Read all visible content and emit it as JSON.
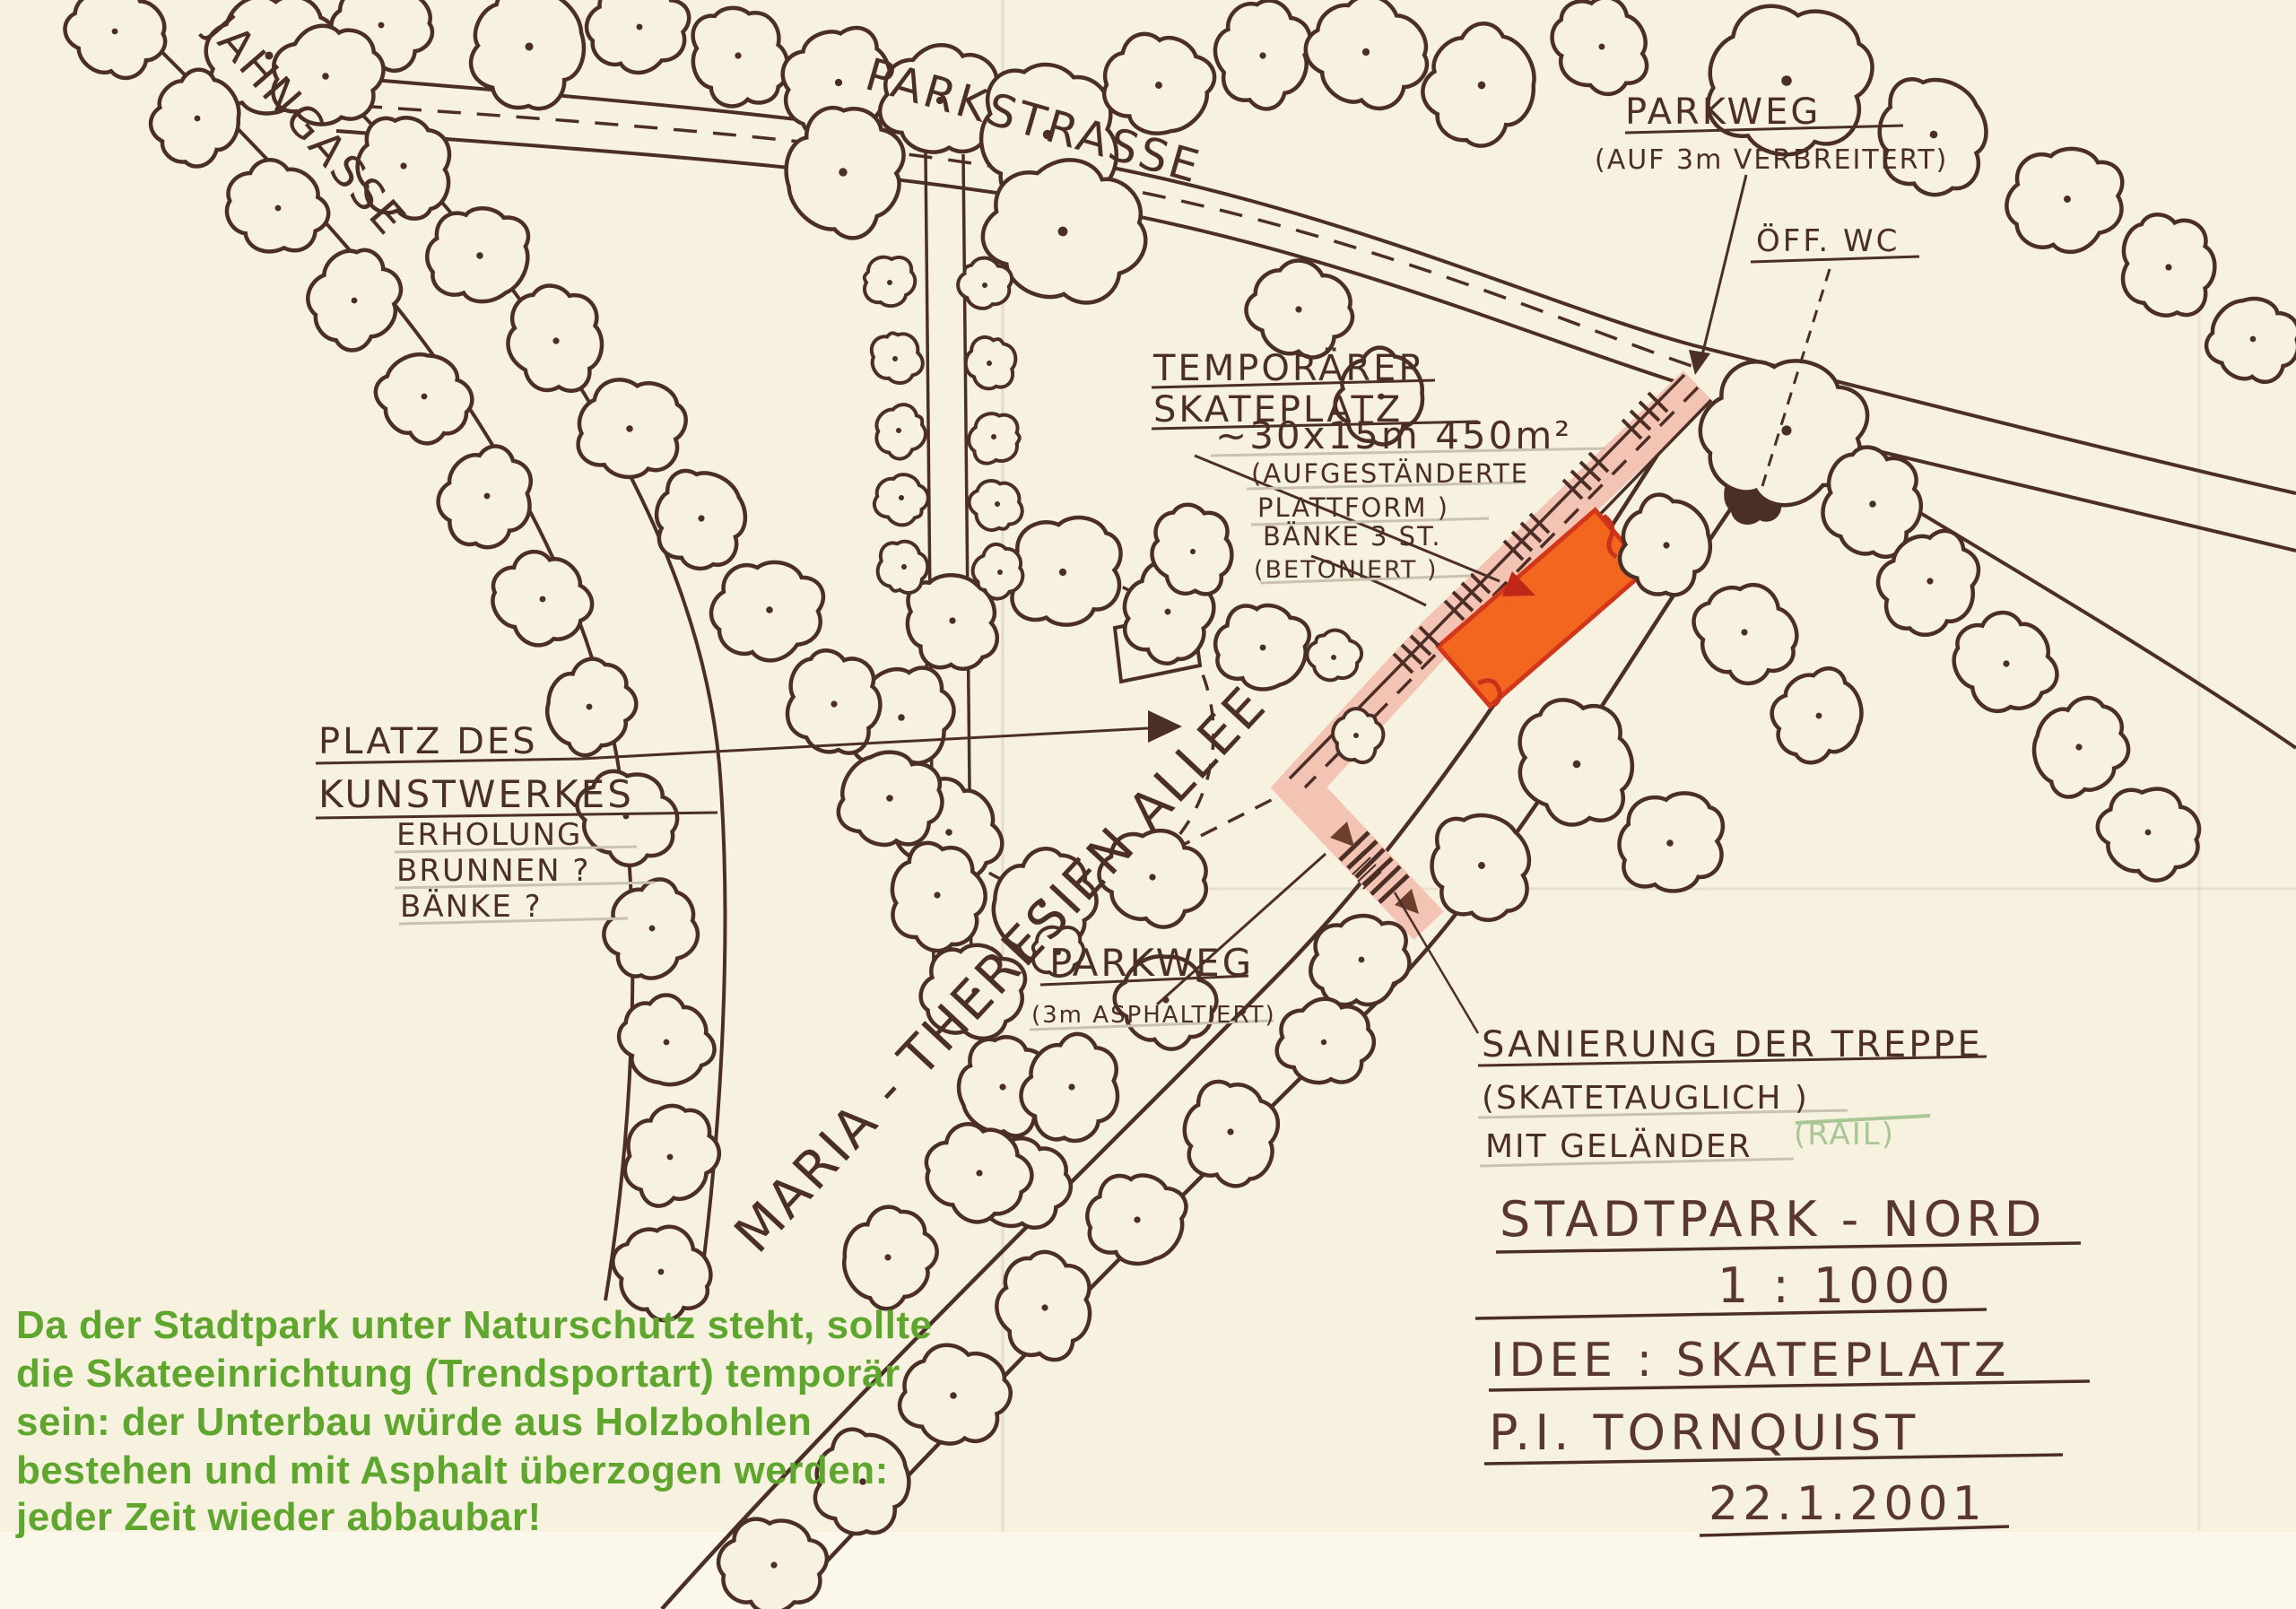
{
  "drawing_title": "STADTPARK - NORD",
  "labels": {
    "jahngasse": "JAHNGASSE",
    "parkstrasse": "PARKSTRASSE",
    "allee": "MARIA - THERESIEN  ALLEE",
    "parkweg_top_1": "PARKWEG",
    "parkweg_top_2": "(AUF 3m VERBREITERT)",
    "wc": "ÖFF. WC",
    "skate_1": "TEMPORÄRER",
    "skate_2": "SKATEPLATZ",
    "skate_3": "~30x15m  450m²",
    "skate_4": "(AUFGESTÄNDERTE",
    "skate_5": "PLATTFORM )",
    "baenke_1": "BÄNKE 3 ST.",
    "baenke_2": "(BETONIERT )",
    "kunst_1": "PLATZ DES",
    "kunst_2": "KUNSTWERKES",
    "kunst_3": "ERHOLUNG",
    "kunst_4": "BRUNNEN ?",
    "kunst_5": "BÄNKE ?",
    "parkweg_low_1": "PARKWEG",
    "parkweg_low_2": "(3m ASPHALTIERT)",
    "treppe_1": "SANIERUNG DER TREPPE",
    "treppe_2": "(SKATETAUGLICH )",
    "treppe_3": "MIT GELÄNDER",
    "treppe_rail": "(RAIL)"
  },
  "title": {
    "lines": [
      "STADTPARK - NORD",
      "1 : 1000",
      "IDEE : SKATEPLATZ",
      "P.I. TORNQUIST",
      "22.1.2001"
    ]
  },
  "note": {
    "lines": [
      "Da der Stadtpark unter Naturschutz steht, sollte",
      "die Skateeinrichtung  (Trendsportart) temporär",
      "sein: der Unterbau würde aus Holzbohlen",
      "bestehen und mit Asphalt überzogen werden:",
      "jeder Zeit wieder abbaubar!"
    ]
  },
  "colors": {
    "paper": "#f7f1df",
    "ink": "#4b2e26",
    "skateplatz_orange": "#f2661f",
    "skateplatz_outline": "#d2371a",
    "path_pink": "#f3c3b3",
    "arrow_red": "#c02718",
    "note_green": "#5fa62f",
    "rail_green": "#a9c795"
  }
}
